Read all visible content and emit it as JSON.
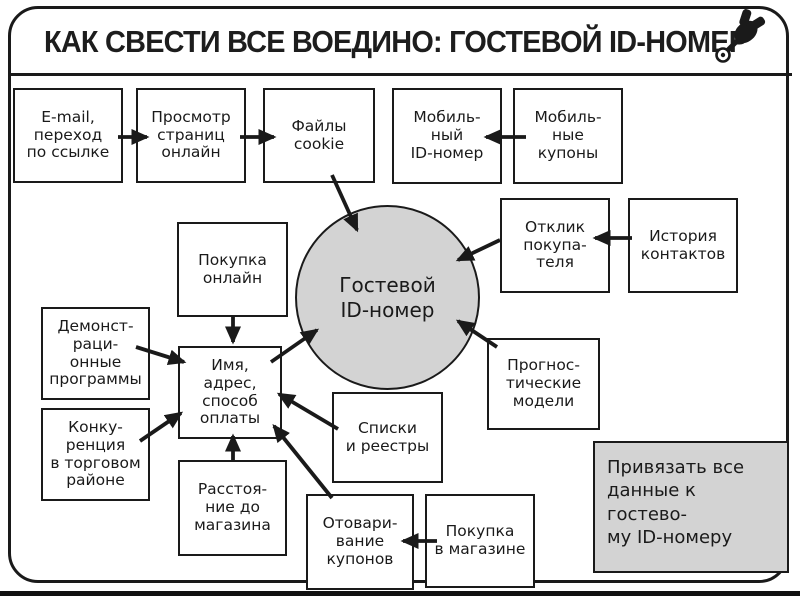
{
  "title": "КАК СВЕСТИ ВСЕ ВОЕДИНО: ГОСТЕВОЙ ID-НОМЕР",
  "colors": {
    "ink": "#1a1a1a",
    "shape_fill": "#d3d3d3",
    "background": "#ffffff"
  },
  "icons": {
    "pushpin": "pushpin-icon"
  },
  "center_circle": {
    "label": "Гостевой\nID-номер"
  },
  "boxes": [
    {
      "id": "email-link",
      "label": "E-mail,\nпереход\nпо ссылке"
    },
    {
      "id": "page-views-online",
      "label": "Просмотр\nстраниц\nонлайн"
    },
    {
      "id": "cookie-files",
      "label": "Файлы\ncookie"
    },
    {
      "id": "mobile-id",
      "label": "Мобиль-\nный\nID-номер"
    },
    {
      "id": "mobile-coupons",
      "label": "Мобиль-\nные\nкупоны"
    },
    {
      "id": "customer-response",
      "label": "Отклик\nпокупа-\nтеля"
    },
    {
      "id": "contact-history",
      "label": "История\nконтактов"
    },
    {
      "id": "online-purchase",
      "label": "Покупка\nонлайн"
    },
    {
      "id": "demo-programs",
      "label": "Демонст-\nраци-\nонные\nпрограммы"
    },
    {
      "id": "competition-in-area",
      "label": "Конку-\nренция\nв торговом\nрайоне"
    },
    {
      "id": "name-address-payment",
      "label": "Имя,\nадрес,\nспособ\nоплаты"
    },
    {
      "id": "lists-registers",
      "label": "Списки\nи реестры"
    },
    {
      "id": "predictive-models",
      "label": "Прогнос-\nтические\nмодели"
    },
    {
      "id": "distance-to-store",
      "label": "Расстоя-\nние до\nмагазина"
    },
    {
      "id": "coupon-redemption",
      "label": "Отовари-\nвание\nкупонов"
    },
    {
      "id": "in-store-purchase",
      "label": "Покупка\nв магазине"
    }
  ],
  "note": {
    "label": "Привязать все\nданные к гостево-\nму ID-номеру"
  }
}
